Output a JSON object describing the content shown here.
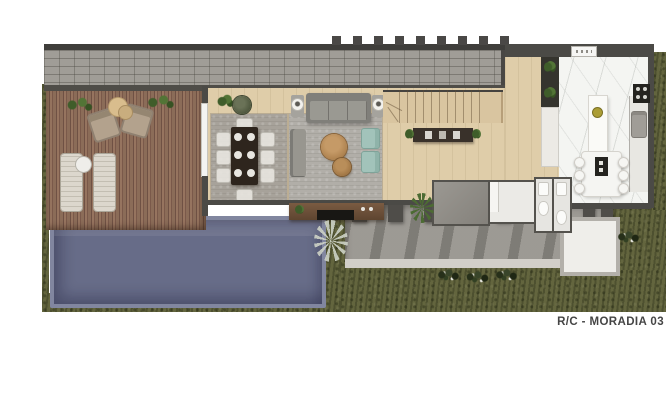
{
  "caption": {
    "text": "R/C - MORADIA 03"
  },
  "scene": {
    "kind": "architectural floor plan render, top view",
    "elements": [
      "garden-grass",
      "swimming-pool",
      "wood-deck",
      "sun-loungers",
      "outdoor-armchairs",
      "gravel-roof-strip",
      "pergola-beams",
      "living-room-sofa",
      "teal-armchairs",
      "coffee-tables",
      "dining-table-8-chairs",
      "staircase",
      "console-sideboard",
      "kitchen-island-with-stools",
      "cooktop",
      "bathrooms",
      "terrace-with-shadows",
      "shrubs",
      "palm-plants"
    ]
  },
  "palette": {
    "background": "#ffffff",
    "grass": "#63653e",
    "pool_water": "#676c88",
    "pool_rim": "#81869f",
    "deck_wood": "#84675a",
    "roof_gravel": "#a09d97",
    "wall_dark": "#4b4a46",
    "wood_floor": "#dfcda9",
    "marble_floor": "#f4f5f2",
    "rug_gray": "#a7a29a",
    "sofa_gray": "#91908a",
    "accent_teal": "#a2c3ba",
    "terrace_gray": "#a4a19b",
    "label_text": "#454545"
  }
}
